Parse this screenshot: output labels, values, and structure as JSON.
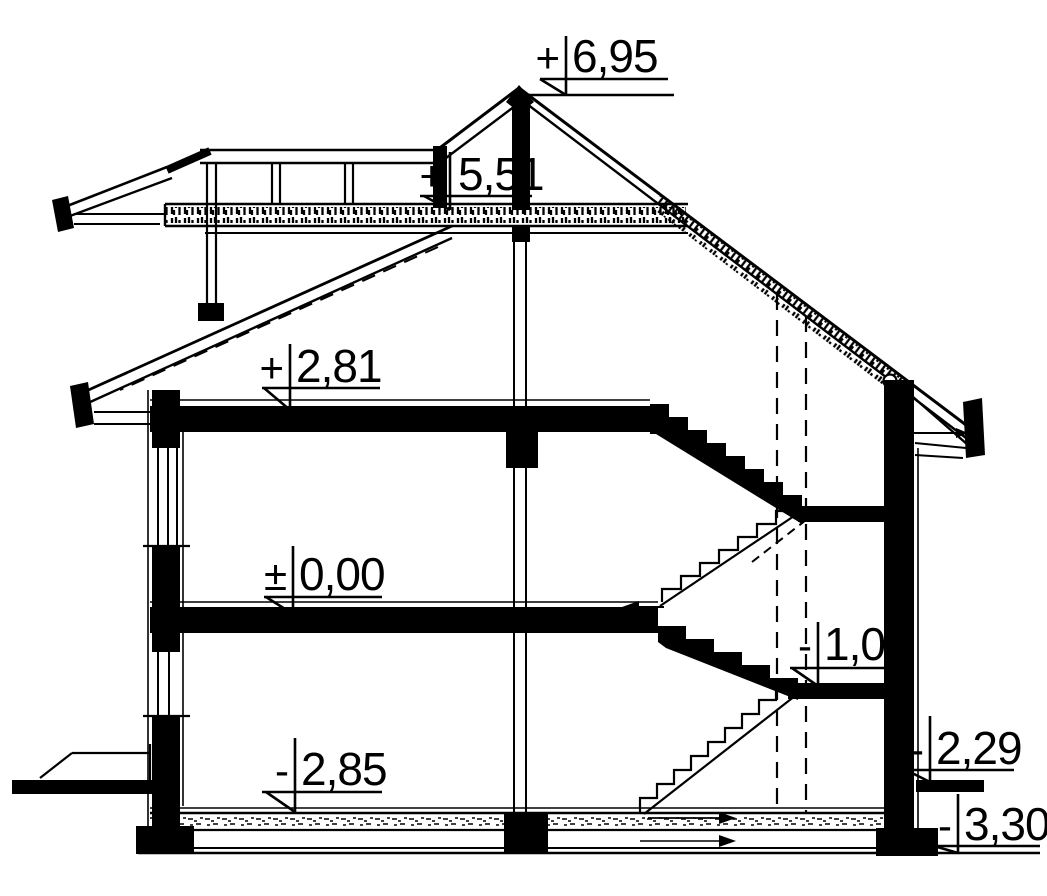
{
  "drawing": {
    "type": "architectural cross-section",
    "units": "meters",
    "background": "#ffffff",
    "line_color": "#000000",
    "elevation_markers": [
      {
        "id": "ridge",
        "sign": "+",
        "value": "6,95"
      },
      {
        "id": "attic-floor",
        "sign": "+",
        "value": "5,51"
      },
      {
        "id": "first-floor",
        "sign": "+",
        "value": "2,81"
      },
      {
        "id": "ground-floor",
        "sign": "±",
        "value": "0,00"
      },
      {
        "id": "stair-landing",
        "sign": "-",
        "value": "1,05"
      },
      {
        "id": "basement-floor",
        "sign": "-",
        "value": "2,85"
      },
      {
        "id": "exterior-grade",
        "sign": "-",
        "value": "2,29"
      },
      {
        "id": "foundation-bottom",
        "sign": "-",
        "value": "3,30"
      }
    ]
  }
}
